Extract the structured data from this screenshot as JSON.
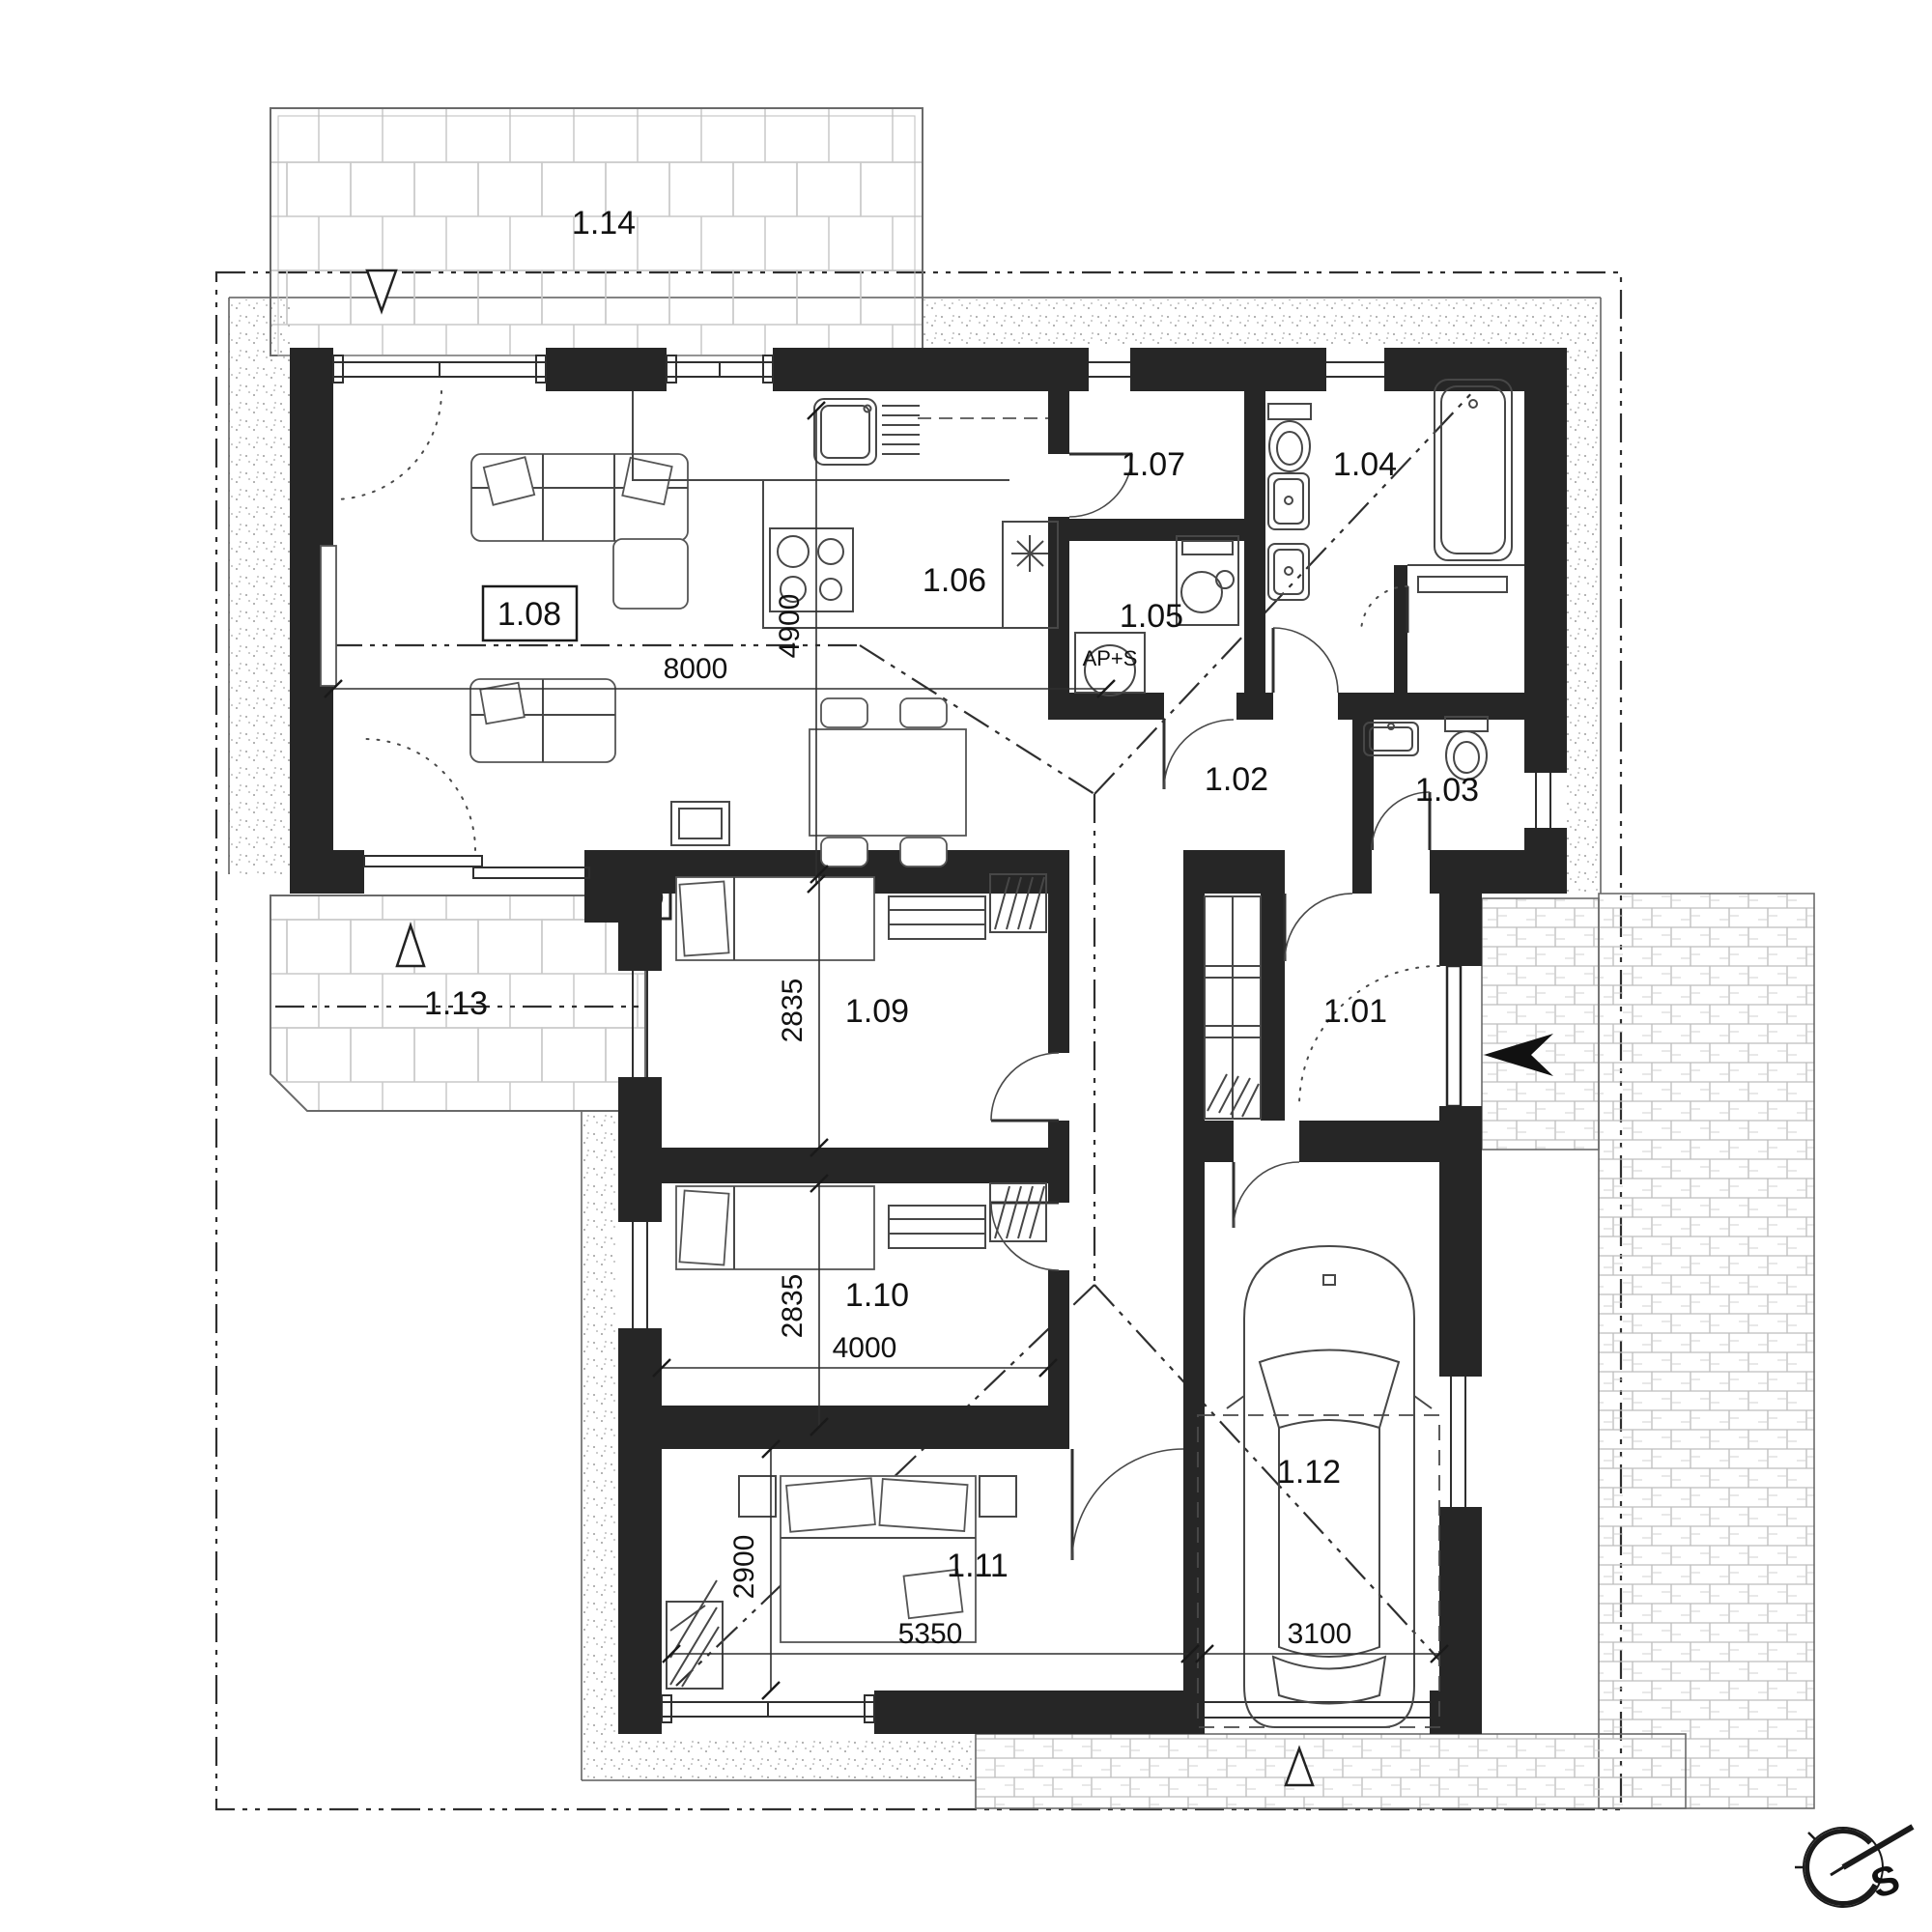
{
  "plan": {
    "rooms": {
      "r101": {
        "label": "1.01"
      },
      "r102": {
        "label": "1.02"
      },
      "r103": {
        "label": "1.03"
      },
      "r104": {
        "label": "1.04"
      },
      "r105": {
        "label": "1.05"
      },
      "r106": {
        "label": "1.06"
      },
      "r107": {
        "label": "1.07"
      },
      "r108": {
        "label": "1.08"
      },
      "r109": {
        "label": "1.09"
      },
      "r110": {
        "label": "1.10"
      },
      "r111": {
        "label": "1.11"
      },
      "r112": {
        "label": "1.12"
      },
      "r113": {
        "label": "1.13"
      },
      "r114": {
        "label": "1.14"
      }
    },
    "dimensions": {
      "living_width": "8000",
      "living_depth": "4900",
      "bedroom1_depth": "2835",
      "bedroom2_depth": "2835",
      "bedroom2_width": "4000",
      "bedroom3_depth": "2900",
      "bedroom3_width": "5350",
      "garage_width": "3100"
    },
    "annotations": {
      "appliance_label": "AP+S",
      "compass_direction": "S"
    },
    "style": {
      "wall_color": "#262626",
      "line_color": "#3f3f3f",
      "paper_color": "#ffffff"
    }
  }
}
